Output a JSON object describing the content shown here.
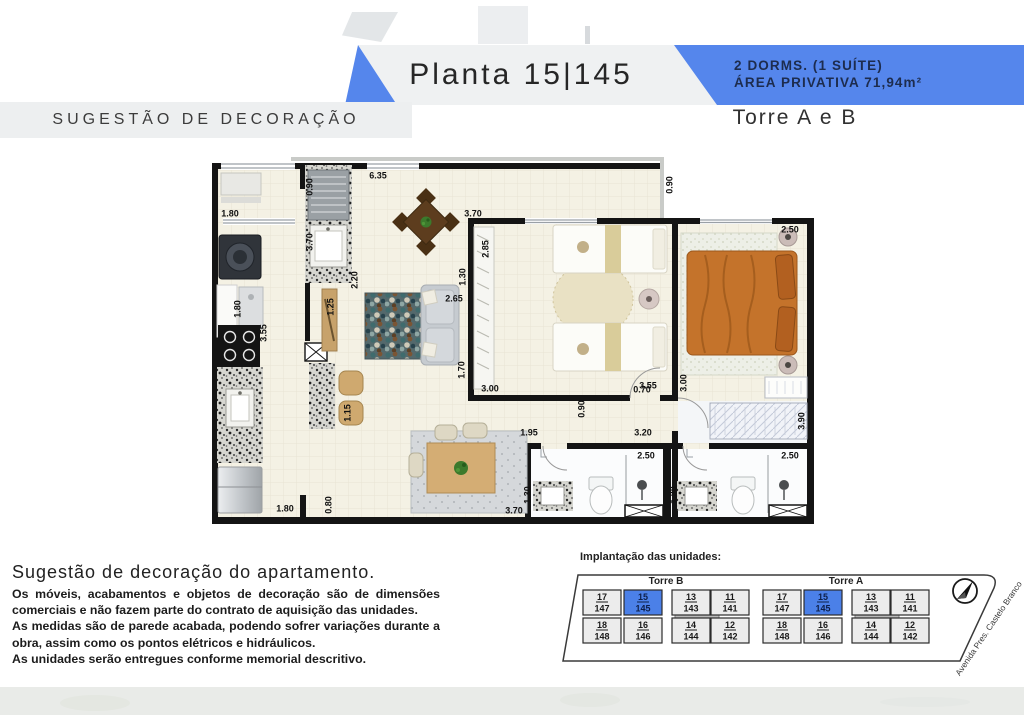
{
  "colors": {
    "accent_blue": "#5586ec",
    "band_gray": "#eff1f2",
    "unit_highlight": "#4b80e8",
    "footer_gray": "#e9ebe8"
  },
  "header": {
    "plan_title": "Planta 15|145",
    "spec_line1": "2 DORMS. (1 SUÍTE)",
    "spec_line2": "ÁREA PRIVATIVA 71,94m²",
    "tower_label": "Torre A e B",
    "decor_banner": "SUGESTÃO DE DECORAÇÃO"
  },
  "plan": {
    "dimensions": [
      {
        "t": "0.90",
        "x": 105,
        "y": 30,
        "r": 1
      },
      {
        "t": "6.35",
        "x": 173,
        "y": 19,
        "r": 0
      },
      {
        "t": "1.80",
        "x": 25,
        "y": 57,
        "r": 0
      },
      {
        "t": "3.70",
        "x": 105,
        "y": 85,
        "r": 1
      },
      {
        "t": "2.20",
        "x": 150,
        "y": 123,
        "r": 1
      },
      {
        "t": "1.80",
        "x": 33,
        "y": 152,
        "r": 1
      },
      {
        "t": "3.55",
        "x": 59,
        "y": 176,
        "r": 1
      },
      {
        "t": "1.25",
        "x": 126,
        "y": 150,
        "r": 1
      },
      {
        "t": "2.65",
        "x": 249,
        "y": 142,
        "r": 0
      },
      {
        "t": "1.70",
        "x": 257,
        "y": 213,
        "r": 1
      },
      {
        "t": "3.70",
        "x": 268,
        "y": 57,
        "r": 0
      },
      {
        "t": "2.85",
        "x": 281,
        "y": 92,
        "r": 1
      },
      {
        "t": "1.30",
        "x": 258,
        "y": 120,
        "r": 1
      },
      {
        "t": "0.90",
        "x": 465,
        "y": 28,
        "r": 1
      },
      {
        "t": "2.50",
        "x": 585,
        "y": 73,
        "r": 0
      },
      {
        "t": "3.55",
        "x": 443,
        "y": 229,
        "r": 0
      },
      {
        "t": "3.00",
        "x": 479,
        "y": 226,
        "r": 1
      },
      {
        "t": "0.70",
        "x": 437,
        "y": 233,
        "r": 0
      },
      {
        "t": "3.00",
        "x": 285,
        "y": 232,
        "r": 0
      },
      {
        "t": "0.90",
        "x": 377,
        "y": 252,
        "r": 1
      },
      {
        "t": "1.95",
        "x": 324,
        "y": 276,
        "r": 0
      },
      {
        "t": "3.20",
        "x": 438,
        "y": 276,
        "r": 0
      },
      {
        "t": "2.50",
        "x": 441,
        "y": 299,
        "r": 0
      },
      {
        "t": "2.50",
        "x": 585,
        "y": 299,
        "r": 0
      },
      {
        "t": "3.90",
        "x": 597,
        "y": 264,
        "r": 1
      },
      {
        "t": "1.30",
        "x": 323,
        "y": 338,
        "r": 1
      },
      {
        "t": "1.30",
        "x": 469,
        "y": 338,
        "r": 1
      },
      {
        "t": "3.70",
        "x": 309,
        "y": 354,
        "r": 0
      },
      {
        "t": "0.80",
        "x": 124,
        "y": 348,
        "r": 1
      },
      {
        "t": "1.80",
        "x": 80,
        "y": 352,
        "r": 0
      },
      {
        "t": "1.15",
        "x": 143,
        "y": 256,
        "r": 1
      }
    ]
  },
  "disclaimer": {
    "title": "Sugestão de decoração do apartamento.",
    "lines": [
      "Os móveis, acabamentos e objetos de decoração são de dimensões comerciais e não fazem parte do contrato de aquisição das unidades.",
      "As medidas são de parede acabada, podendo sofrer variações durante a obra, assim como os pontos elétricos e hidráulicos.",
      "As unidades serão entregues conforme memorial descritivo."
    ]
  },
  "site": {
    "label": "Implantação das unidades:",
    "street": "Avenida Pres. Castelo Branco",
    "towers": [
      {
        "name": "Torre B",
        "x": 35,
        "rows": [
          [
            {
              "top": "17",
              "bottom": "147"
            },
            {
              "top": "15",
              "bottom": "145",
              "highlight": true
            },
            {
              "top": "13",
              "bottom": "143"
            },
            {
              "top": "11",
              "bottom": "141"
            }
          ],
          [
            {
              "top": "18",
              "bottom": "148"
            },
            {
              "top": "16",
              "bottom": "146"
            },
            {
              "top": "14",
              "bottom": "144"
            },
            {
              "top": "12",
              "bottom": "142"
            }
          ]
        ]
      },
      {
        "name": "Torre A",
        "x": 215,
        "rows": [
          [
            {
              "top": "17",
              "bottom": "147"
            },
            {
              "top": "15",
              "bottom": "145",
              "highlight": true
            },
            {
              "top": "13",
              "bottom": "143"
            },
            {
              "top": "11",
              "bottom": "141"
            }
          ],
          [
            {
              "top": "18",
              "bottom": "148"
            },
            {
              "top": "16",
              "bottom": "146"
            },
            {
              "top": "14",
              "bottom": "144"
            },
            {
              "top": "12",
              "bottom": "142"
            }
          ]
        ]
      }
    ]
  }
}
